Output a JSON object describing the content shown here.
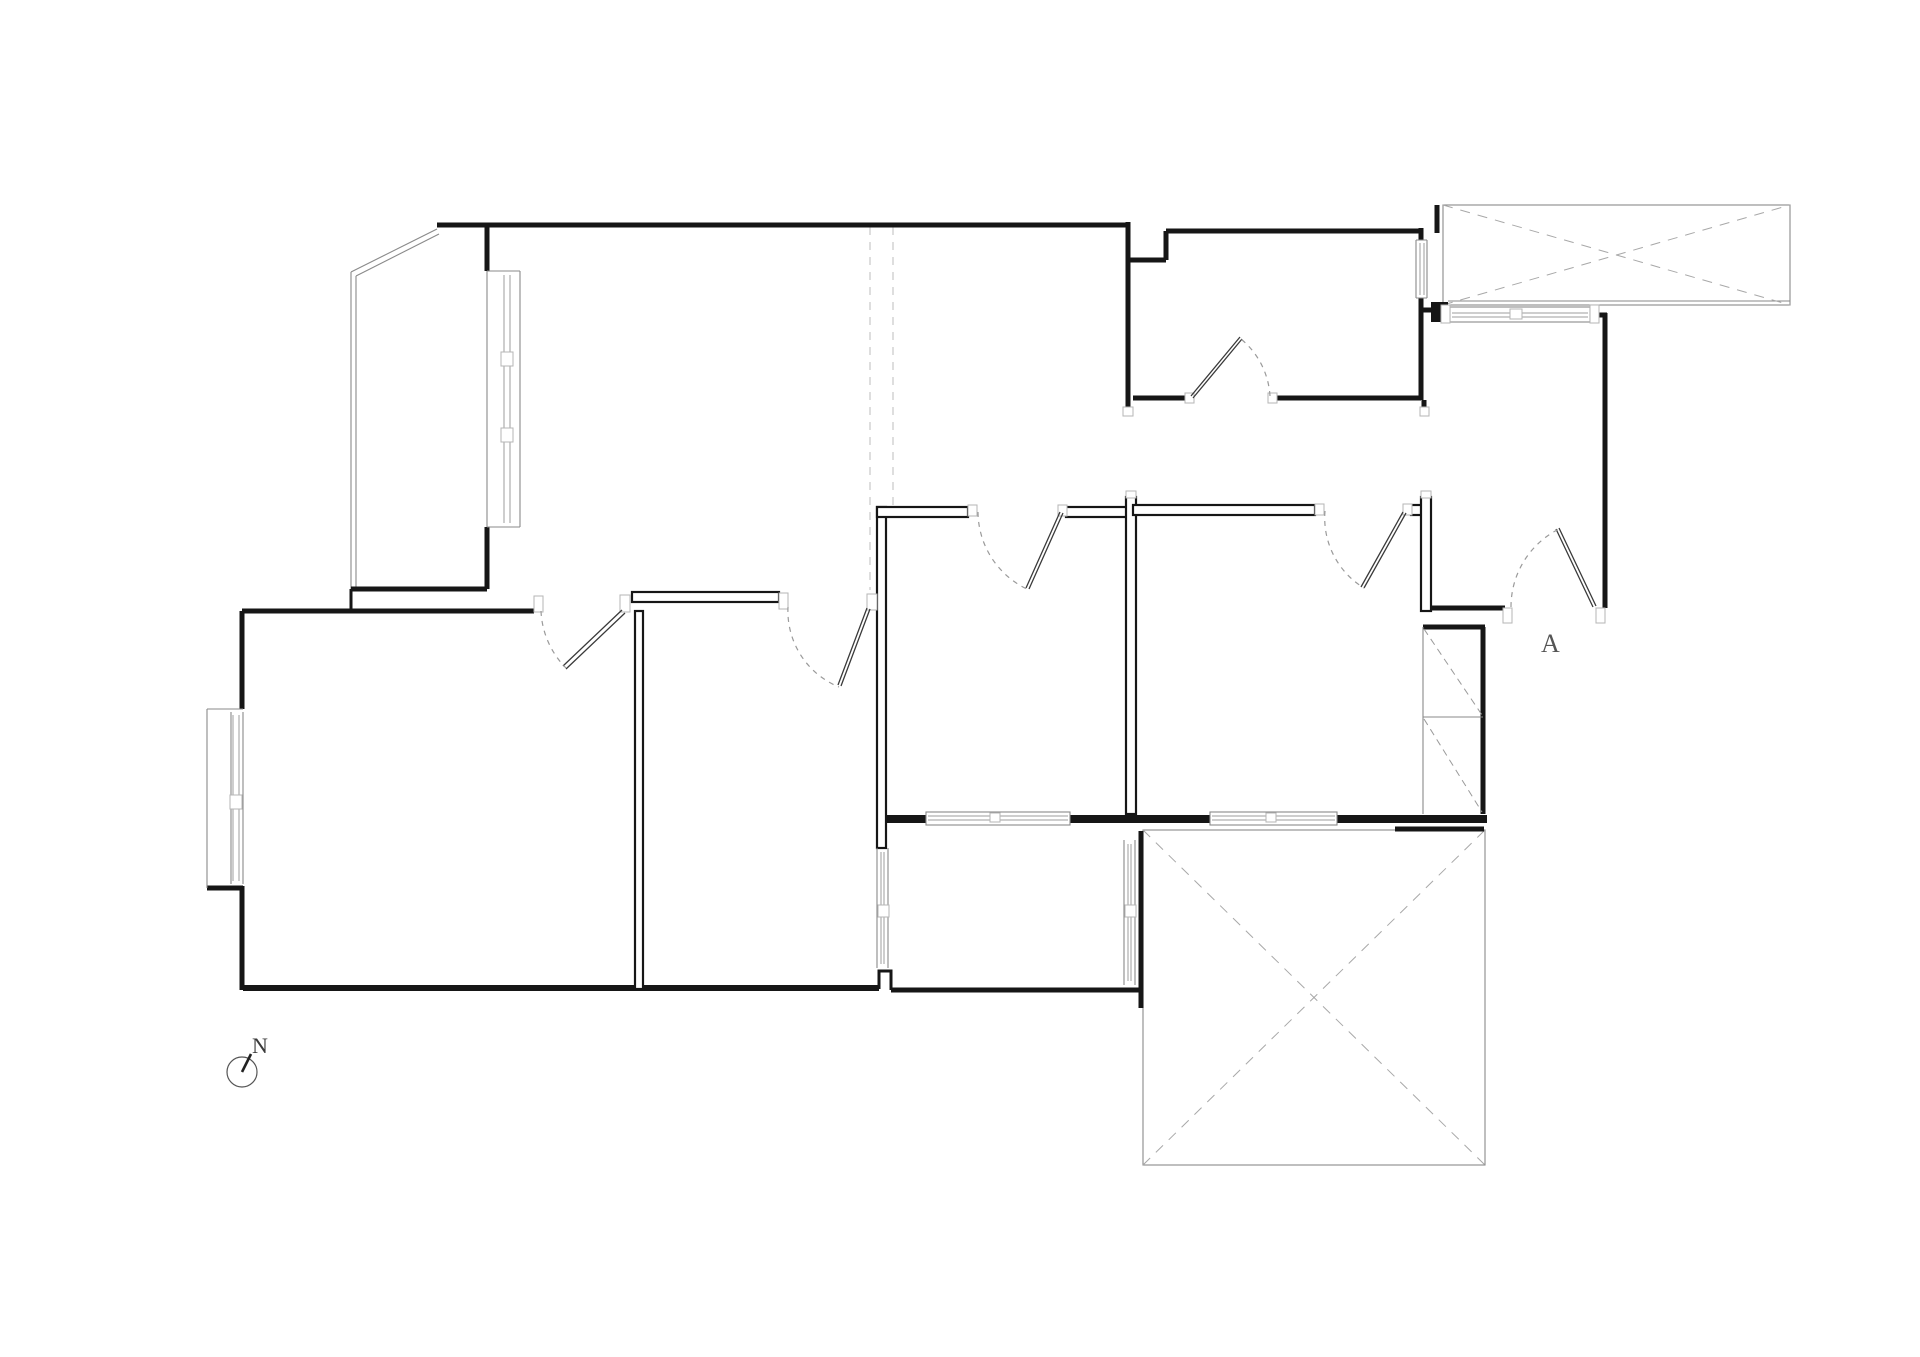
{
  "meta": {
    "drawing_type": "architectural floor plan",
    "background": "#ffffff"
  },
  "annotations": {
    "compass": {
      "label": "N"
    },
    "section_marker": {
      "label": "A"
    }
  },
  "colors": {
    "wall": "#161616",
    "thin_line": "#8a8a8a",
    "dashed_line": "#9a9a9a",
    "beam_dashed": "#d6d6d6",
    "text": "#3a3a3a",
    "background": "#ffffff"
  },
  "features": {
    "balcony_top_left": "chamfered balcony with tall window",
    "balcony_top_right": "balcony slab with dashed X",
    "terrace_bottom_right": "large terrace slab with dashed X",
    "sunroom_bottom_center": "enclosed balcony with side windows",
    "wardrobe_right": "built-in wardrobe with dashed diagonals",
    "door_count": 6,
    "sliding_window_count": 3
  }
}
